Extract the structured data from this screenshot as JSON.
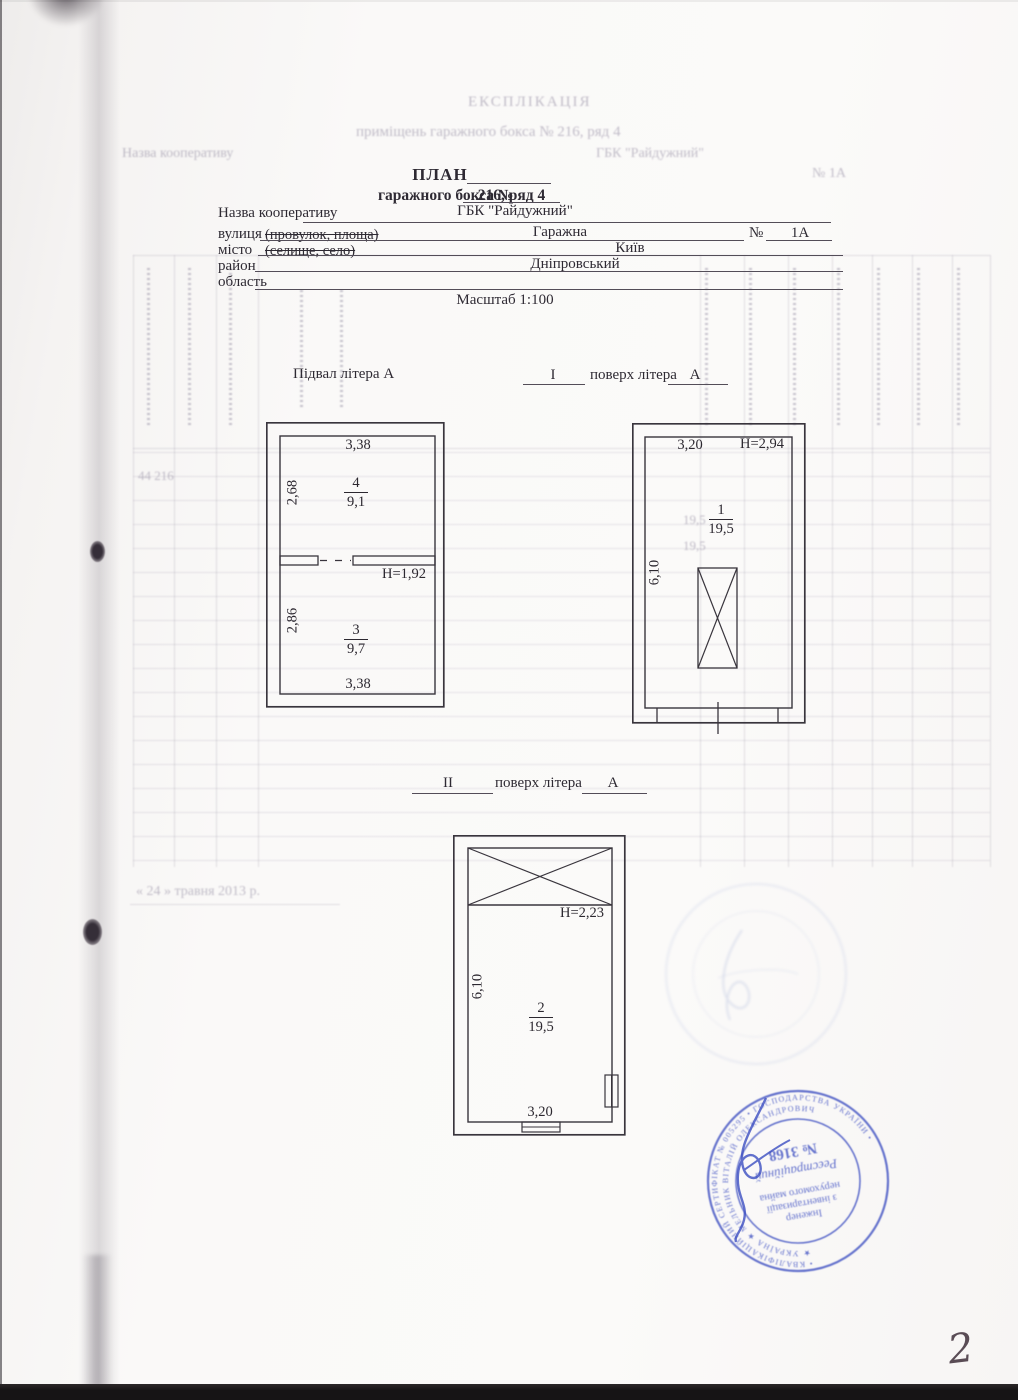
{
  "document": {
    "title": "ПЛАН",
    "subtitle_prefix": "гаражного бокса №",
    "subtitle_value": "216, ряд 4",
    "scale": "Масштаб 1:100",
    "page_number": "2"
  },
  "form": {
    "row1_label": "Назва кооперативу",
    "row1_value": "ГБК \"Райдужний\"",
    "row2_label": "вулиця",
    "row2_hint": "(провулок, площа)",
    "row2_value": "Гаражна",
    "row2_no_label": "№",
    "row2_no_value": "1А",
    "row3_label": "місто",
    "row3_hint": "(селище, село)",
    "row3_value": "Київ",
    "row4_label": "район",
    "row4_value": "Дніпровський",
    "row5_label": "область",
    "row5_value": ""
  },
  "sections": {
    "basement_label": "Підвал літера А",
    "floor1_numeral": "І",
    "floor1_label": "поверх літера",
    "floor1_letter": "А",
    "floor2_numeral": "ІІ",
    "floor2_label": "поверх літера",
    "floor2_letter": "А"
  },
  "basement_plan": {
    "dim_top": "3,38",
    "dim_bottom": "3,38",
    "dim_left_top": "2,68",
    "dim_left_bottom": "2,86",
    "room_top_number": "4",
    "room_top_area": "9,1",
    "room_bottom_number": "3",
    "room_bottom_area": "9,7",
    "height_label": "Н=1,92"
  },
  "floor1_plan": {
    "dim_top": "3,20",
    "height_label": "Н=2,94",
    "dim_left": "6,10",
    "room_number": "1",
    "room_area": "19,5"
  },
  "floor2_plan": {
    "dim_left": "6,10",
    "dim_bottom": "3,20",
    "height_label": "Н=2,23",
    "room_number": "2",
    "room_area": "19,5"
  },
  "stamp": {
    "color": "#4d5dc6",
    "center_line1": "Інженер",
    "center_line2": "з інвентаризації",
    "center_line3": "нерухомого майна",
    "center_line4": "Реєстраційний",
    "center_line5": "№ 3168",
    "ring_inner": "★ УКРАЇНА ★  МЕЛЬНИК ВІТАЛІЙ ОЛЕКСАНДРОВИЧ",
    "ring_outer": "• КВАЛІФІКАЦІЙНИЙ СЕРТИФІКАТ № 005295 • ГОСПОДАРСТВА УКРАЇНИ •"
  },
  "bleed_through": {
    "heading1": "ЕКСПЛІКАЦІЯ",
    "heading2": "приміщень гаражного бокса № 216, ряд 4",
    "heading3": "ГБК \"Райдужний\"",
    "left_label": "Назва кооперативу",
    "street_no": "№   1А",
    "table_numbers": "44    216",
    "value1": "19,5",
    "value2": "19,5",
    "date_line": "« 24 »        травня        2013 р."
  }
}
